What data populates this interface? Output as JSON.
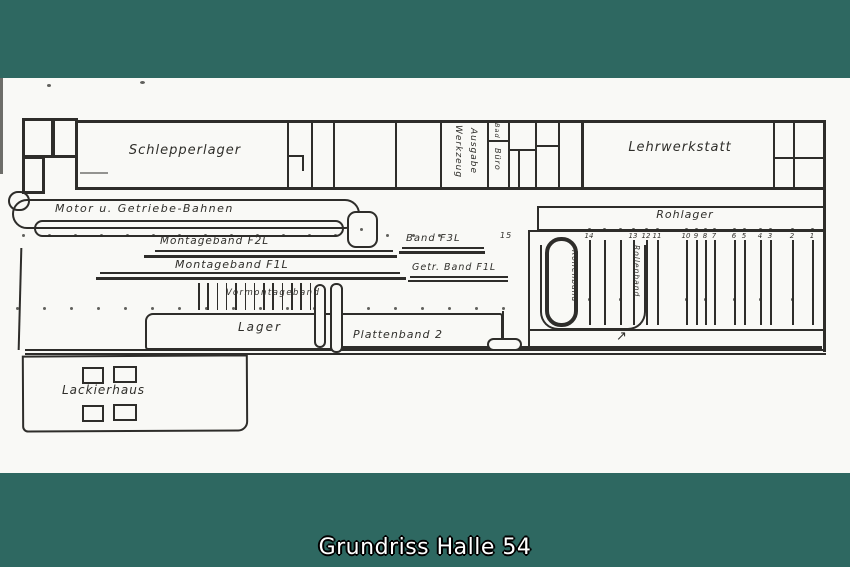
{
  "caption": "Grundriss Halle 54",
  "colors": {
    "background_teal": "#2e6861",
    "paper": "#f9f9f6",
    "ink": "#2e2d2a"
  },
  "plan": {
    "rooms": {
      "schlepperlager": "Schlepperlager",
      "werkzeug": "Werkzeug",
      "ausgabe": "Ausgabe",
      "bad": "Bad",
      "buero": "Büro",
      "lehrwerkstatt": "Lehrwerkstatt",
      "rohlager": "Rohlager",
      "lager": "Lager",
      "lackierhaus": "Lackierhaus"
    },
    "conveyors": {
      "motor_getriebe_bahnen": "Motor u. Getriebe-Bahnen",
      "montageband_f2l": "Montageband F2L",
      "band_f3l": "Band F3L",
      "montageband_f1l": "Montageband F1L",
      "getr_band_f1l": "Getr. Band F1L",
      "vormontageband": "Vormontageband",
      "plattenband_2": "Plattenband 2",
      "rollenband_loop": "Rollenband",
      "rollenband_line": "Rollenband"
    },
    "stations": {
      "gate_label": "15",
      "flow_arrow": "↗",
      "lines": [
        {
          "x": 589,
          "n": "14"
        },
        {
          "x": 604,
          "n": ""
        },
        {
          "x": 620,
          "n": ""
        },
        {
          "x": 633,
          "n": "13"
        },
        {
          "x": 646,
          "n": "12"
        },
        {
          "x": 657,
          "n": "11"
        },
        {
          "x": 686,
          "n": "10"
        },
        {
          "x": 696,
          "n": "9"
        },
        {
          "x": 705,
          "n": "8"
        },
        {
          "x": 714,
          "n": "7"
        },
        {
          "x": 734,
          "n": "6"
        },
        {
          "x": 744,
          "n": "5"
        },
        {
          "x": 760,
          "n": "4"
        },
        {
          "x": 770,
          "n": "3"
        },
        {
          "x": 792,
          "n": "2"
        },
        {
          "x": 812,
          "n": "1"
        }
      ]
    }
  }
}
